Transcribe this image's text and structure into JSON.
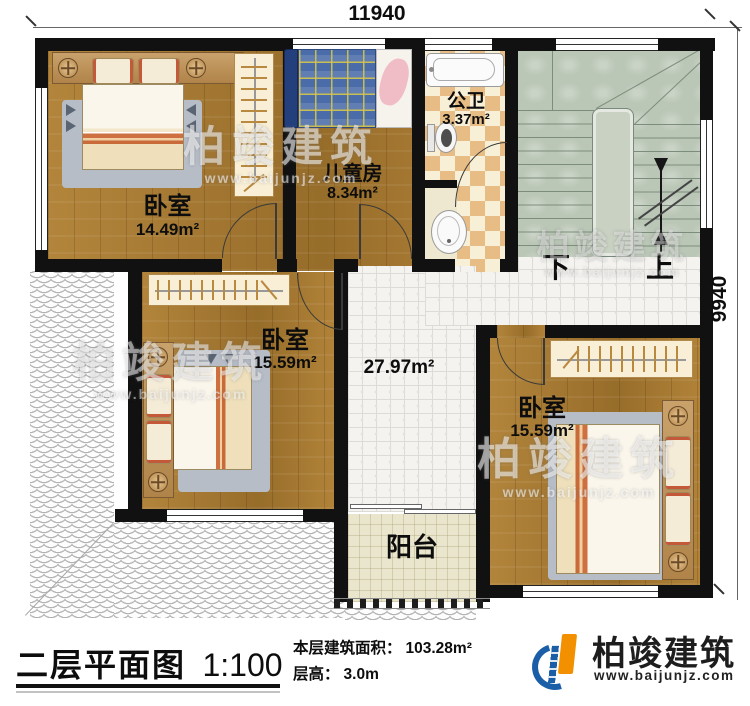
{
  "dimensions": {
    "width_label": "11940",
    "height_label": "9940"
  },
  "rooms": [
    {
      "name": "卧室",
      "area": "14.49m²"
    },
    {
      "name": "儿童房",
      "area": "8.34m²"
    },
    {
      "name": "公卫",
      "area": "3.37m²"
    },
    {
      "name": "卧室",
      "area": "15.59m²"
    },
    {
      "name": "卧室",
      "area": "15.59m²"
    },
    {
      "name": "阳台",
      "area": ""
    }
  ],
  "hall": {
    "area": "27.97m²"
  },
  "stairs": {
    "down_label": "下",
    "up_label": "上"
  },
  "titleblock": {
    "plan_title": "二层平面图",
    "scale": "1:100",
    "floor_area_label": "本层建筑面积：",
    "floor_area_value": "103.28m²",
    "floor_height_label": "层高：",
    "floor_height_value": "3.0m"
  },
  "brand": {
    "name": "柏竣建筑",
    "website": "www.baijunjz.com"
  }
}
